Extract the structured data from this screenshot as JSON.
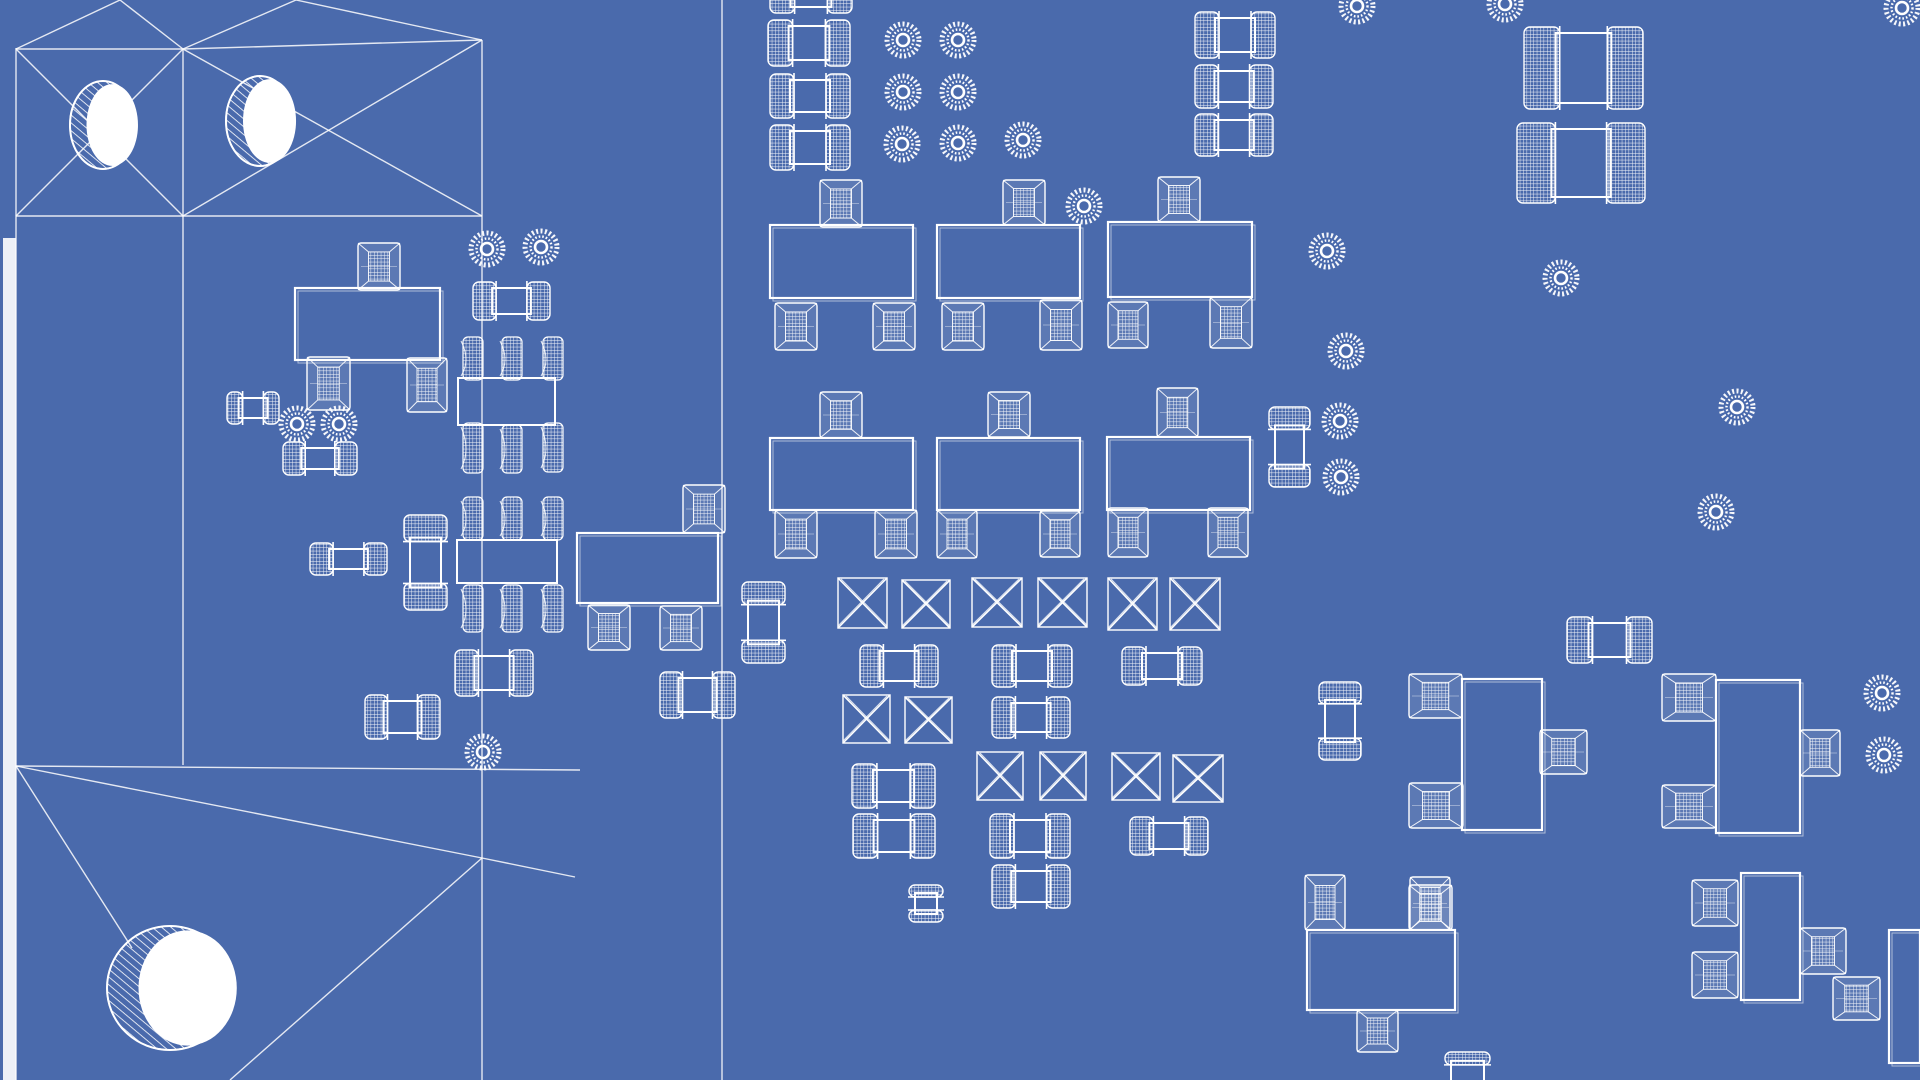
{
  "scene": {
    "label": "blueprint-style 3D wireframe rendering of a printed circuit board, top view",
    "width": 1920,
    "height": 1080,
    "background_color": "#4a6aac",
    "wire_color": "#ffffff",
    "board_edge_band": {
      "x": 3,
      "y": 238,
      "w": 13,
      "h": 842
    }
  },
  "mesh_lines": [
    [
      16,
      48,
      16,
      1080
    ],
    [
      183,
      49,
      183,
      765
    ],
    [
      482,
      40,
      482,
      1080
    ],
    [
      722,
      0,
      722,
      1080
    ],
    [
      16,
      49,
      183,
      49
    ],
    [
      183,
      49,
      482,
      40
    ],
    [
      16,
      216,
      482,
      216
    ],
    [
      16,
      766,
      580,
      770
    ],
    [
      16,
      49,
      120,
      0
    ],
    [
      120,
      0,
      183,
      49
    ],
    [
      183,
      49,
      296,
      0
    ],
    [
      296,
      0,
      482,
      40
    ],
    [
      16,
      49,
      183,
      216
    ],
    [
      16,
      216,
      183,
      49
    ],
    [
      183,
      49,
      482,
      216
    ],
    [
      183,
      216,
      482,
      40
    ],
    [
      16,
      766,
      482,
      858
    ],
    [
      482,
      858,
      230,
      1080
    ],
    [
      16,
      766,
      132,
      948
    ],
    [
      482,
      858,
      575,
      877
    ]
  ],
  "cylinders": [
    {
      "cx": 103,
      "cy": 125,
      "rx": 33,
      "ry": 44
    },
    {
      "cx": 260,
      "cy": 121,
      "rx": 34,
      "ry": 45
    },
    {
      "cx": 170,
      "cy": 988,
      "rx": 63,
      "ry": 62
    }
  ],
  "pads": [
    [
      903,
      40
    ],
    [
      958,
      40
    ],
    [
      903,
      92
    ],
    [
      958,
      92
    ],
    [
      902,
      144
    ],
    [
      958,
      143
    ],
    [
      1023,
      140
    ],
    [
      1084,
      206
    ],
    [
      1357,
      6
    ],
    [
      1505,
      4
    ],
    [
      1902,
      8
    ],
    [
      1327,
      251
    ],
    [
      1346,
      351
    ],
    [
      1340,
      421
    ],
    [
      1341,
      477
    ],
    [
      1561,
      278
    ],
    [
      1737,
      407
    ],
    [
      1716,
      512
    ],
    [
      297,
      424
    ],
    [
      339,
      424
    ],
    [
      487,
      249
    ],
    [
      541,
      247
    ],
    [
      1882,
      693
    ],
    [
      1884,
      755
    ],
    [
      483,
      752
    ]
  ],
  "chip_caps_h": [
    [
      770,
      -30,
      82,
      40
    ],
    [
      768,
      23,
      82,
      40
    ],
    [
      770,
      77,
      80,
      38
    ],
    [
      770,
      128,
      80,
      39
    ],
    [
      1195,
      15,
      80,
      40
    ],
    [
      1195,
      68,
      78,
      37
    ],
    [
      1195,
      117,
      78,
      36
    ],
    [
      1524,
      30,
      119,
      76
    ],
    [
      1517,
      126,
      128,
      74
    ],
    [
      473,
      285,
      77,
      32
    ],
    [
      283,
      445,
      74,
      27
    ],
    [
      310,
      546,
      77,
      26
    ],
    [
      227,
      395,
      52,
      26
    ],
    [
      455,
      653,
      78,
      40
    ],
    [
      365,
      698,
      75,
      38
    ],
    [
      660,
      675,
      75,
      40
    ],
    [
      860,
      648,
      78,
      36
    ],
    [
      992,
      648,
      80,
      36
    ],
    [
      1122,
      650,
      80,
      32
    ],
    [
      852,
      767,
      83,
      38
    ],
    [
      853,
      817,
      82,
      38
    ],
    [
      990,
      817,
      80,
      38
    ],
    [
      992,
      868,
      78,
      37
    ],
    [
      992,
      700,
      78,
      35
    ],
    [
      1130,
      820,
      78,
      32
    ],
    [
      1567,
      620,
      85,
      40
    ]
  ],
  "chip_caps_v": [
    [
      745,
      582,
      37,
      81
    ],
    [
      1322,
      682,
      36,
      78
    ],
    [
      407,
      515,
      37,
      95
    ],
    [
      1272,
      407,
      35,
      80
    ],
    [
      1448,
      1052,
      39,
      46
    ],
    [
      912,
      885,
      28,
      37
    ]
  ],
  "x_pads": [
    [
      838,
      578,
      49,
      50
    ],
    [
      902,
      580,
      48,
      48
    ],
    [
      972,
      578,
      50,
      49
    ],
    [
      1038,
      578,
      49,
      49
    ],
    [
      1108,
      578,
      49,
      52
    ],
    [
      1170,
      578,
      50,
      52
    ],
    [
      843,
      695,
      47,
      48
    ],
    [
      905,
      697,
      47,
      46
    ],
    [
      977,
      752,
      46,
      48
    ],
    [
      1040,
      752,
      46,
      48
    ],
    [
      1112,
      753,
      48,
      47
    ],
    [
      1173,
      755,
      50,
      47
    ]
  ],
  "sot_packages": [
    {
      "body": [
        770,
        225,
        143,
        73
      ],
      "leads": [
        [
          820,
          180,
          42,
          47
        ],
        [
          775,
          303,
          42,
          47
        ],
        [
          873,
          303,
          42,
          47
        ]
      ]
    },
    {
      "body": [
        937,
        225,
        143,
        73
      ],
      "leads": [
        [
          1003,
          180,
          42,
          45
        ],
        [
          942,
          303,
          42,
          47
        ],
        [
          1040,
          300,
          42,
          50
        ]
      ]
    },
    {
      "body": [
        1108,
        222,
        144,
        75
      ],
      "leads": [
        [
          1158,
          177,
          42,
          45
        ],
        [
          1108,
          302,
          40,
          46
        ],
        [
          1210,
          297,
          42,
          51
        ]
      ]
    },
    {
      "body": [
        770,
        438,
        143,
        72
      ],
      "leads": [
        [
          820,
          392,
          42,
          46
        ],
        [
          775,
          510,
          42,
          48
        ],
        [
          875,
          510,
          42,
          48
        ]
      ]
    },
    {
      "body": [
        937,
        438,
        143,
        72
      ],
      "leads": [
        [
          988,
          392,
          42,
          45
        ],
        [
          937,
          510,
          40,
          48
        ],
        [
          1040,
          511,
          40,
          46
        ]
      ]
    },
    {
      "body": [
        1107,
        437,
        143,
        73
      ],
      "leads": [
        [
          1157,
          388,
          41,
          49
        ],
        [
          1108,
          508,
          40,
          49
        ],
        [
          1208,
          508,
          40,
          49
        ]
      ]
    },
    {
      "body": [
        295,
        288,
        145,
        72
      ],
      "leads": [
        [
          358,
          243,
          42,
          47
        ],
        [
          307,
          357,
          43,
          53
        ],
        [
          407,
          358,
          40,
          54
        ]
      ]
    },
    {
      "body": [
        577,
        533,
        141,
        70
      ],
      "leads": [
        [
          683,
          485,
          42,
          48
        ],
        [
          588,
          605,
          42,
          45
        ],
        [
          660,
          606,
          42,
          44
        ]
      ]
    },
    {
      "body": [
        1307,
        930,
        148,
        80
      ],
      "leads": [
        [
          1305,
          875,
          40,
          55
        ],
        [
          1410,
          877,
          40,
          53
        ],
        [
          1357,
          1010,
          41,
          42
        ]
      ]
    },
    {
      "body": [
        1462,
        679,
        80,
        151
      ],
      "leads": [
        [
          1409,
          674,
          53,
          44
        ],
        [
          1409,
          783,
          54,
          45
        ],
        [
          1540,
          730,
          47,
          44
        ]
      ]
    },
    {
      "body": [
        1716,
        680,
        84,
        153
      ],
      "leads": [
        [
          1662,
          674,
          54,
          47
        ],
        [
          1662,
          785,
          54,
          43
        ],
        [
          1800,
          730,
          40,
          46
        ]
      ]
    },
    {
      "body": [
        1741,
        873,
        59,
        127
      ],
      "leads": [
        [
          1692,
          880,
          46,
          46
        ],
        [
          1692,
          952,
          46,
          46
        ],
        [
          1800,
          928,
          46,
          46
        ]
      ]
    },
    {
      "body": [
        1889,
        930,
        31,
        133
      ],
      "leads": [
        [
          1833,
          977,
          47,
          43
        ]
      ]
    }
  ],
  "ic_packages": [
    {
      "body": [
        458,
        378,
        97,
        47
      ],
      "leads": [
        [
          463,
          337,
          20,
          43
        ],
        [
          502,
          337,
          20,
          43
        ],
        [
          543,
          337,
          20,
          43
        ],
        [
          463,
          423,
          20,
          50
        ],
        [
          502,
          425,
          20,
          48
        ],
        [
          543,
          423,
          20,
          49
        ]
      ]
    },
    {
      "body": [
        457,
        540,
        100,
        43
      ],
      "leads": [
        [
          463,
          497,
          20,
          43
        ],
        [
          502,
          497,
          20,
          43
        ],
        [
          543,
          497,
          20,
          43
        ],
        [
          463,
          585,
          20,
          47
        ],
        [
          502,
          585,
          20,
          47
        ],
        [
          543,
          585,
          20,
          47
        ]
      ]
    }
  ],
  "solo_leads": [
    [
      1409,
      885,
      43,
      45
    ]
  ]
}
